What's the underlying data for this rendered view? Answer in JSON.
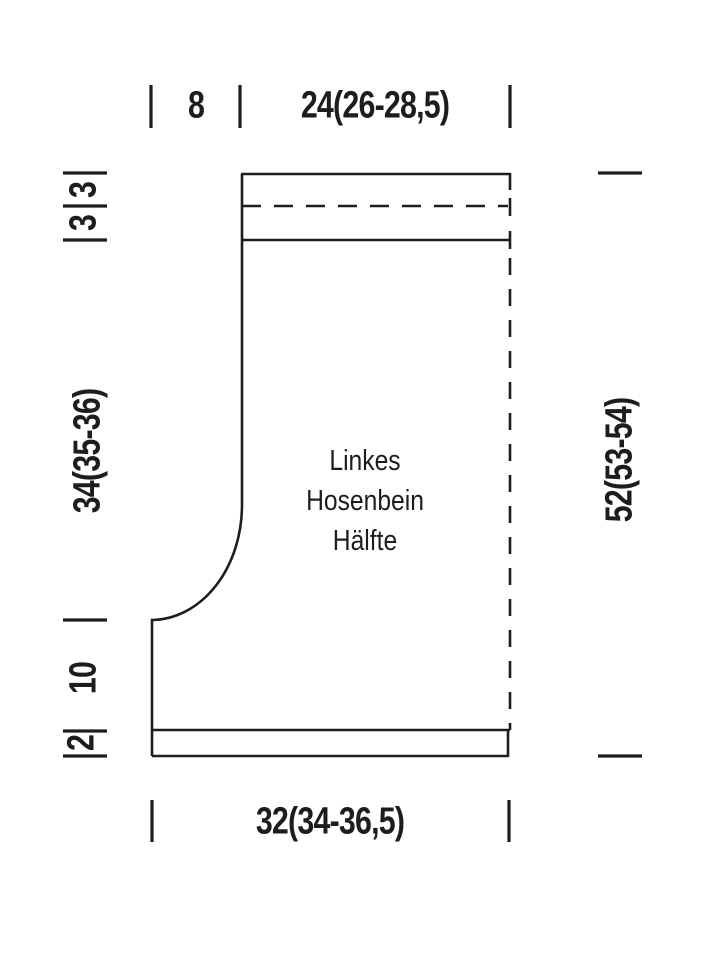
{
  "figure": {
    "piece_title_lines": [
      "Linkes",
      "Hosenbein",
      "Hälfte"
    ],
    "measurements": {
      "top_segment_small": "8",
      "top_width": "24(26-28,5)",
      "left_band_upper": "3",
      "left_band_lower": "3",
      "left_side_length": "34(35-36)",
      "left_lower_length": "10",
      "left_hem_height": "2",
      "right_total_length": "52(53-54)",
      "bottom_width": "32(34-36,5)"
    },
    "colors": {
      "ink": "#1d1d1b",
      "background": "#ffffff"
    }
  }
}
